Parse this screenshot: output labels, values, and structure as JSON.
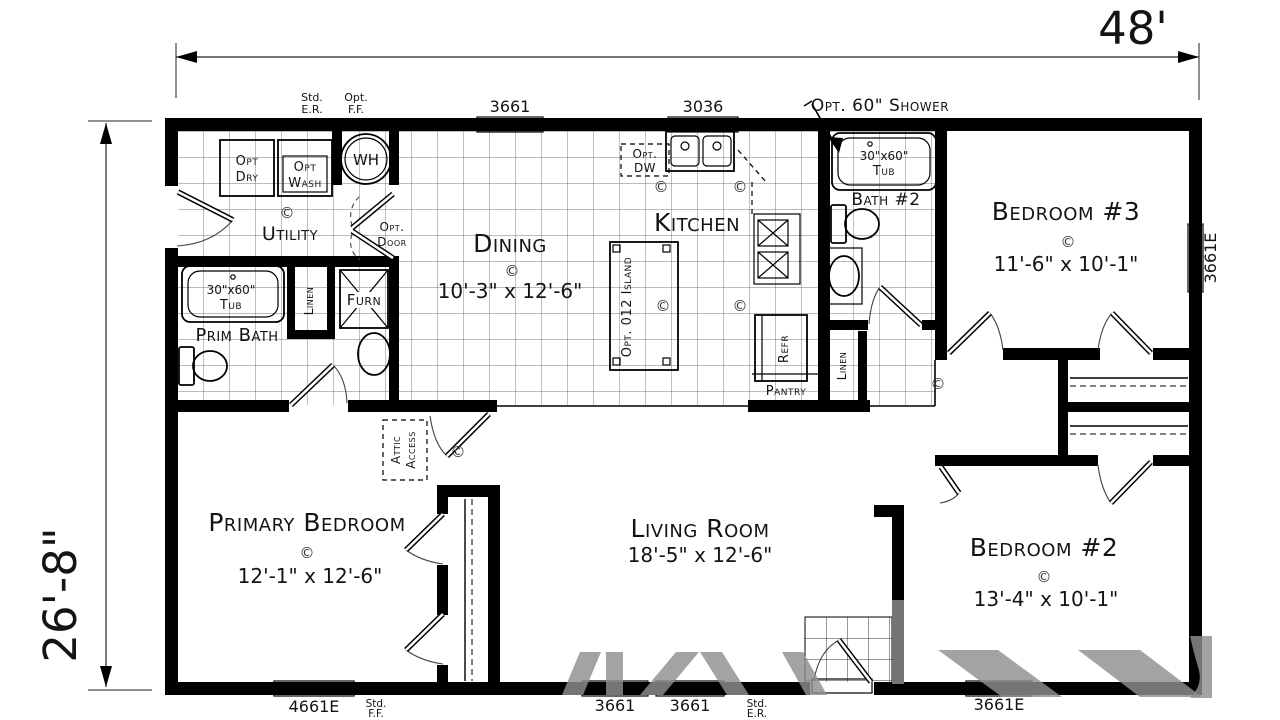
{
  "dimensions": {
    "width_label": "48'",
    "depth_label": "26'-8\""
  },
  "rooms": {
    "utility": {
      "name": "Utility"
    },
    "dining": {
      "name": "Dining",
      "size": "10'-3\" x 12'-6\""
    },
    "kitchen": {
      "name": "Kitchen"
    },
    "prim_bath": {
      "name": "Prim Bath"
    },
    "bath2": {
      "name": "Bath #2"
    },
    "bedroom3": {
      "name": "Bedroom #3",
      "size": "11'-6\" x 10'-1\""
    },
    "primary_bedroom": {
      "name": "Primary Bedroom",
      "size": "12'-1\" x 12'-6\""
    },
    "living_room": {
      "name": "Living Room",
      "size": "18'-5\" x 12'-6\""
    },
    "bedroom2": {
      "name": "Bedroom #2",
      "size": "13'-4\" x 10'-1\""
    },
    "pantry": {
      "name": "Pantry"
    }
  },
  "fixtures": {
    "water_heater": "WH",
    "furnace": "Furn",
    "refrigerator": "Refr",
    "island": "Opt. 012 Island",
    "linen_bath": "Linen",
    "linen_hall": "Linen",
    "dryer": [
      "Opt",
      "Dry"
    ],
    "washer": [
      "Opt",
      "Wash"
    ],
    "dishwasher": [
      "Opt.",
      "DW"
    ],
    "tub_primary": [
      "30\"x60\"",
      "Tub"
    ],
    "tub_bath2": [
      "30\"x60\"",
      "Tub"
    ]
  },
  "annotations": {
    "copyright": "©",
    "std_er": [
      "Std.",
      "E.R."
    ],
    "opt_ff": [
      "Opt.",
      "F.F."
    ],
    "std_ff": [
      "Std.",
      "F.F."
    ],
    "std_er_bottom": [
      "Std.",
      "E.R."
    ],
    "opt_shower": "Opt. 60\" Shower",
    "opt_door": [
      "Opt.",
      "Door"
    ],
    "attic_access": [
      "Attic",
      "Access"
    ]
  },
  "windows": {
    "top_dining": "3661",
    "top_kitchen": "3036",
    "right_bedroom3": "3661E",
    "bottom_primary": "4661E",
    "bottom_living_a": "3661",
    "bottom_living_b": "3661",
    "bottom_bedroom2": "3661E"
  },
  "colors": {
    "wall": "#000000",
    "tile_line": "#4a4a4a",
    "watermark": "#8f8f8f"
  }
}
